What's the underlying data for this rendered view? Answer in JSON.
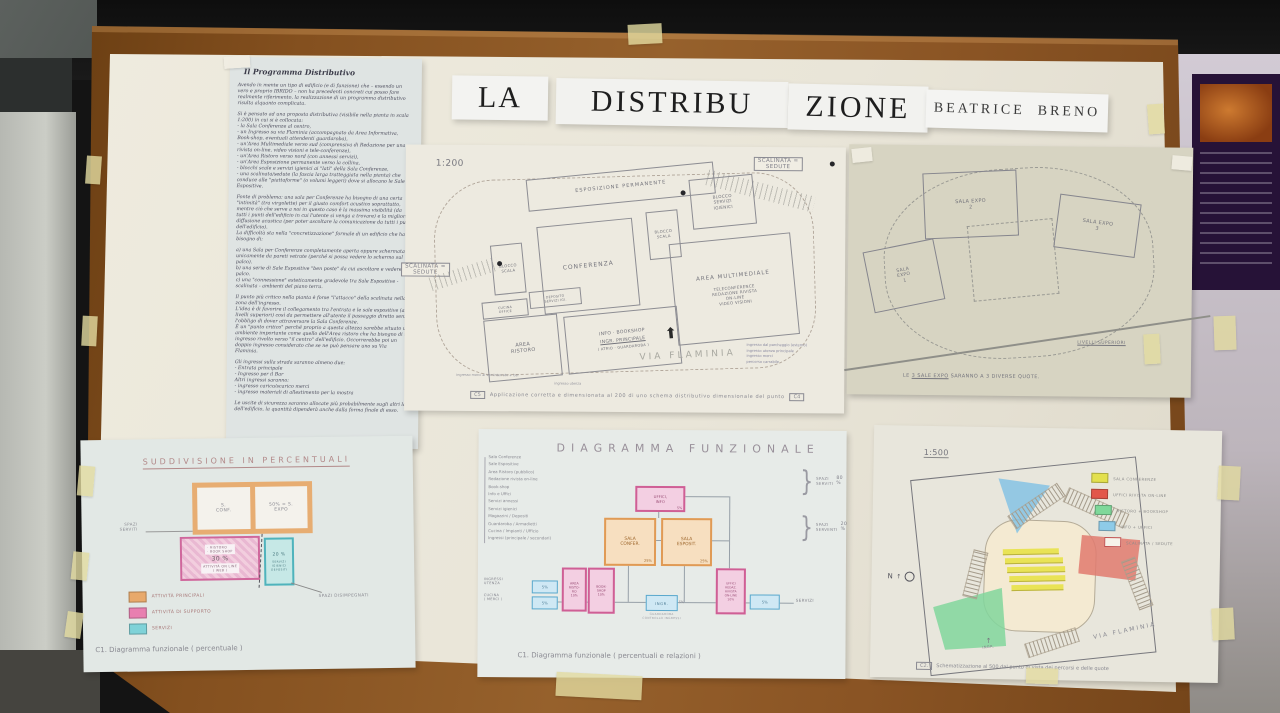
{
  "board": {
    "header": {
      "la": "LA",
      "distribu": "DISTRIBU",
      "zione": "ZIONE",
      "author": "BEATRICE  BRENO"
    },
    "program": {
      "heading": "Il Programma Distributivo",
      "paragraphs": [
        "Avendo in mente un tipo di edificio (e di funzione) che – essendo un vero e proprio IBRIDO – non ha precedenti concreti cui posso fare realmente riferimento, la realizzazione di un programma distributivo risulta alquanto complicata.",
        "Si è pensato ad una proposta distributiva (visibile nella pianta in scala 1:200) in cui si è collocata:\n- la Sala Conferenze al centro,\n- un Ingresso su via Flaminia (accompagnato da Area Informativa, Book-shop, eventuali attendenti guardaroba),\n- un'Area Multimediale verso sud (comprensiva di Redazione per una rivista on-line, video visioni e tele-conferenze),\n- un'Area Ristoro verso nord (con annessi servizi),\n- un'Area Esposizione permanente verso la collina,\n- blocchi scale e servizi igienici ai \"lati\" della Sala Conferenze,\n- una scalinata/sedute (la fascia larga tratteggiata nella pianta) che conduce alle \"piattaforme\" (o volumi leggeri) dove si allocano le Sale Espositive.",
        "Fonte di problema: una sala per Conferenze ha bisogno di una certa \"intimità\" (tra virgolette) per il giusto comfort acustico soprattutto, mentre ciò che serve a noi in questo caso è la massima visibilità (da tutti i punti dell'edificio in cui l'utente si venga a trovare) e la migliore diffusione acustica (per poter ascoltare la comunicazione da tutti i punti dell'edificio).\nLa difficoltà sta nella \"concretizzazione\" formale di un edificio che ha bisogno di:",
        "a) una Sala per Conferenze completamente aperta oppure schermata unicamente da pareti vetrate (perché si possa vedere lo schermo sul palco).\nb) una serie di Sale Espositive \"ben poste\" da cui ascoltare e vedere il palco.\nc) una \"connessione\" esteticamente gradevole tra Sale Espositive - scalinata - ambienti del piano terra.",
        "Il punto più critico nella pianta è forse \"l'attacco\" della scalinata nella zona dell'ingresso.\nL'idea è di favorire il collegamento tra l'entrata e le sale espositive (ai livelli superiori) così da permettere all'utente il passaggio diretto senza l'obbligo di dover attraversare la Sala Conferenze.\nÈ un \"punto critico\" perché proprio a questa altezza sarebbe situato un ambiente importante come quello dell'Area ristoro che ha bisogno di un ingresso rivolto verso \"il centro\" dell'edificio. Occorrerebbe poi un doppio ingresso considerato che se ne può pensare uno su Via Flaminia.",
        "Gli ingressi sulla strada saranno almeno due:\n- Entrata principale\n- Ingresso per il Bar\nAltri ingressi saranno:\n- ingresso carico/scarico merci\n- ingresso materiali di allestimento per la mostra",
        "Le uscite di sicurezza saranno allocate più probabilmente sugli altri lati dell'edificio, la quantità dipenderà anche dalla forma finale di esso."
      ]
    },
    "plan200": {
      "scale": "1:200",
      "scalinata_right": "SCALINATA =\nSEDUTE",
      "scalinata_left": "SCALINATA =\nSEDUTE",
      "rooms": {
        "esposizione": "ESPOSIZIONE PERMANENTE",
        "blocco_scala_1": "BLOCCO\nSCALA",
        "blocco_scala_2": "BLOCCO\nSCALA",
        "conferenza": "CONFERENZA",
        "servizi": "BLOCCO\nSERVIZI\nIGIENICI",
        "multimediale_title": "AREA MULTIMEDIALE",
        "multimediale_sub": "TELECONFERENCE\nREDAZIONE RIVISTA\nON-LINE\nVIDEO VISIONI",
        "cucina": "CUCINA\nOFFICE",
        "deposito": "DEPOSITO\nSERVIZI IGI.",
        "ristoro": "AREA\nRISTORO",
        "ingresso_1": "INFO · BOOKSHOP",
        "ingresso_2": "INGR. PRINCIPALE",
        "ingresso_3": "( ATRIO · GUARDAROBA )"
      },
      "street": "VIA FLAMINIA",
      "notes": {
        "merci": "ingresso merci al seminterrato + bar",
        "utenza": "ingresso utenza"
      },
      "legend": [
        "ingresso dal parcheggio (esterno)",
        "ingresso utenza principale",
        "ingresso merci",
        "percorso carrabile"
      ],
      "caption_tag": "C5",
      "caption": "Applicazione corretta e dimensionata al 200 di uno schema distributivo dimensionale del punto",
      "caption_tag_end": "C4"
    },
    "levels": {
      "sala2": "SALA EXPO\n2",
      "sala3": "SALA EXPO\n3",
      "sala1": "SALA\nEXPO\n1",
      "note": "LIVELLI SUPERIORI",
      "caption_pre": "LE",
      "caption_mid": "3 SALE EXPO",
      "caption_post": "SARANNO A 3 DIVERSE QUOTE."
    },
    "percent": {
      "title": "SUDDIVISIONE IN PERCENTUALI",
      "conf": "S.\nCONF.",
      "expo": "50% = S.\nEXPO",
      "support_items": "· RISTORO\n· BOOK SHOP",
      "support_pct": "30 %",
      "support_sub": "ATTIVITÀ ON LINE\n( WEB )",
      "services_pct": "20 %",
      "services_sub": "SERVIZI\nIGIENICI\nDEPOSITI",
      "serviti": "SPAZI\nSERVITI",
      "disimpegnati": "SPAZI DISIMPEGNATI",
      "legend": [
        {
          "color": "#e8a96b",
          "label": "ATTIVITÀ PRINCIPALI"
        },
        {
          "color": "#e87fb0",
          "label": "ATTIVITÀ DI SUPPORTO"
        },
        {
          "color": "#7fd2d8",
          "label": "SERVIZI"
        }
      ],
      "caption": "C1.  Diagramma funzionale ( percentuale )"
    },
    "functional": {
      "title": "DIAGRAMMA FUNZIONALE",
      "list": [
        "Sala Conferenze",
        "Sale Espositive",
        "Area Ristoro (pubblico)",
        "Redazione rivista on-line",
        "Book-shop",
        "Info e Uffici",
        "Servizi annessi",
        "Servizi igienici",
        "Magazzini / Depositi",
        "Guardaroba / Armadietti",
        "Cucina / Impianti / Ufficio",
        "Ingressi (principale / secondari)"
      ],
      "serviti": "SPAZI\nSERVITI",
      "serviti_pct": "80 %",
      "serventi": "SPAZI\nSERVENTI",
      "serventi_pct": "20 %",
      "uffici": "UFFICI,\nINFO",
      "uffici_pct": "5%",
      "conf": "SALA\nCONFER.",
      "conf_pct": "25%",
      "expo": "SALA\nESPOSIT.",
      "expo_pct": "25%",
      "in1_pct": "5%",
      "in2_pct": "5%",
      "ristoro": "AREA\nRISTO-\nRO",
      "ristoro_pct": "10%",
      "bookshop": "BOOK-\nSHOP",
      "bookshop_pct": "10%",
      "ingr": "INGR.",
      "ingr_pct": "5%",
      "ingr_note": "GUARDAROBA\nCONTROLLO INGRESSI",
      "redazione": "UFFICI\nREDAZ.\nRIVISTA\nON-LINE",
      "redazione_pct": "10%",
      "out_pct": "5%",
      "label_ingressi": "INGRESSI\nUTENZA",
      "label_cucina": "CUCINA\n( MERCI )",
      "label_servizi": "SERVIZI",
      "caption": "C1.  Diagramma funzionale ( percentuali e relazioni )"
    },
    "plan500": {
      "scale": "1:500",
      "legend": [
        {
          "color": "#e3e04e",
          "label": "SALA CONFERENZE"
        },
        {
          "color": "#e2574b",
          "label": "UFFICI RIVISTA ON-LINE"
        },
        {
          "color": "#7fd89a",
          "label": "RISTORO + BOOKSHOP"
        },
        {
          "color": "#8ecbe8",
          "label": "INFO + UFFICI"
        },
        {
          "color": "#f6f3ea",
          "border": "#c05050",
          "label": "SCALINATA / SEDUTE"
        }
      ],
      "north": "N",
      "street": "VIA FLAMINIA",
      "ingresso": "INGR.",
      "caption_tag": "C2.",
      "caption": "Schematizzazione al 500 dal punto di vista dei percorsi e delle quote"
    }
  }
}
